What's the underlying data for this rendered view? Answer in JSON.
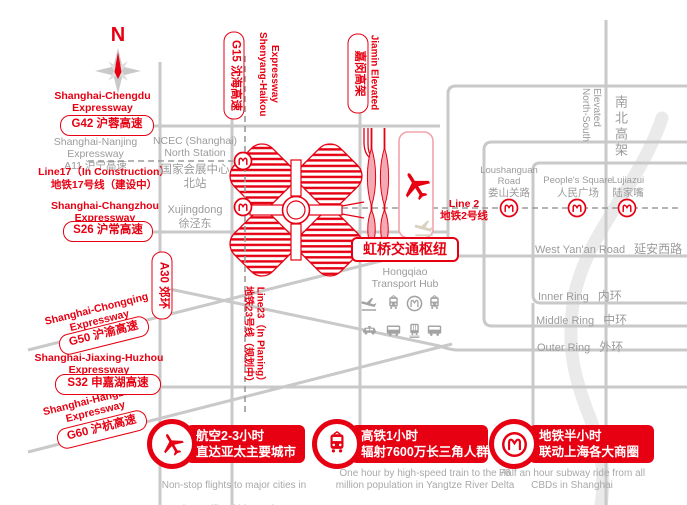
{
  "colors": {
    "red": "#e60012",
    "road_grey": "#c9c9c9",
    "text_grey": "#9b9b9b",
    "river_grey": "#eaeaea"
  },
  "compass": {
    "north": "N"
  },
  "left_labels": {
    "g42_name": "Shanghai-Chengdu\nExpressway",
    "g42_badge": "G42 沪蓉高速",
    "a11": "Shanghai-Nanjing Expressway\nA11 沪宁高速",
    "line17": "Line17（In Construction）\n地铁17号线（建设中）",
    "s26_name": "Shanghai-Changzhou\nExpressway",
    "s26_badge": "S26 沪常高速",
    "a30_badge": "A30 郊环",
    "g50_name": "Shanghai-Chongqing\nExpressway",
    "g50_badge": "G50 沪渝高速",
    "s32_name": "Shanghai-Jiaxing-Huzhou\nExpressway",
    "s32_badge": "S32 申嘉湖高速",
    "g60_name": "Shanghai-Hangzhou\nExpressway",
    "g60_badge": "G60 沪杭高速"
  },
  "top_labels": {
    "g15_badge": "G15 沈海高速",
    "g15_name": "Shenyang-Haikou\nExpressway",
    "jiamin_badge": "嘉闵高架",
    "jiamin_name": "Jiamin Elevated"
  },
  "ncec": {
    "en": "NCEC (Shanghai)\nNorth Station",
    "zh": "国家会展中心\n北站",
    "xujingdong": "Xujingdong\n徐泾东"
  },
  "line23": {
    "en": "Line23（In Planing）",
    "zh": "地铁23号线（规划中）"
  },
  "hub": {
    "badge": "虹桥交通枢纽",
    "name": "Hongqiao\nTransport Hub",
    "icons": [
      "airplane",
      "high-speed-train",
      "metro",
      "intercity-rail",
      "taxi",
      "bus",
      "maglev",
      "coach"
    ]
  },
  "line2": {
    "en": "Line 2",
    "zh": "地铁2号线",
    "stations": [
      {
        "en": "Loushanguan\nRoad",
        "zh": "娄山关路"
      },
      {
        "en": "People's Square",
        "zh": "人民广场"
      },
      {
        "en": "Lujiazui",
        "zh": "陆家嘴"
      }
    ]
  },
  "right_roads": {
    "north_south_en": "North-South\nElevated",
    "north_south_zh": "南北高架",
    "west_yanan_en": "West Yan'an Road",
    "west_yanan_zh": "延安西路",
    "inner_en": "Inner Ring",
    "inner_zh": "内环",
    "middle_en": "Middle Ring",
    "middle_zh": "中环",
    "outer_en": "Outer Ring",
    "outer_zh": "外环"
  },
  "banners": [
    {
      "icon": "airplane",
      "zh_line1": "航空2-3小时",
      "zh_line2": "直达亚太主要城市",
      "en_line1": "Non-stop flights to major cities in",
      "en_line2": "Asia-Pacific within 2-3 hours"
    },
    {
      "icon": "high-speed-train",
      "zh_line1": "高铁1小时",
      "zh_line2": "辐射7600万长三角人群",
      "en_line1": "One hour by high-speed train to the 76",
      "en_line2": "million population in Yangtze River Delta"
    },
    {
      "icon": "metro",
      "zh_line1": "地铁半小时",
      "zh_line2": "联动上海各大商圈",
      "en_line1": "Half an hour subway ride from all",
      "en_line2": "CBDs in Shanghai"
    }
  ]
}
